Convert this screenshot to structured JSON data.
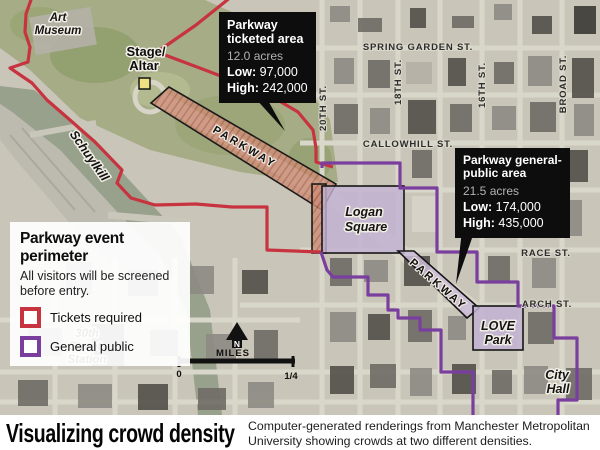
{
  "colors": {
    "tickets_red": "#c73440",
    "public_purple": "#7a3f9e",
    "ticketed_fill": "#cb8d76",
    "public_fill": "#c2b1d2",
    "callout_bg": "#0d0d0d"
  },
  "map": {
    "streets": {
      "spring_garden": "SPRING GARDEN ST.",
      "twentieth": "20TH ST.",
      "eighteenth": "18TH ST.",
      "sixteenth": "16TH ST.",
      "broad": "BROAD ST.",
      "callowhill": "CALLOWHILL ST.",
      "race": "RACE ST.",
      "arch": "ARCH ST."
    },
    "places": {
      "art_museum_1": "Art",
      "art_museum_2": "Museum",
      "stage_1": "Stage/",
      "stage_2": "Altar",
      "schuylkill": "Schuylkill",
      "logan_1": "Logan",
      "logan_2": "Square",
      "love_1": "LOVE",
      "love_2": "Park",
      "city_hall_1": "City",
      "city_hall_2": "Hall",
      "station_1": "30th",
      "station_2": "Street",
      "station_3": "Station",
      "parkway_ticketed": "PARKWAY",
      "parkway_public": "PARKWAY"
    }
  },
  "callouts": {
    "ticketed": {
      "title_1": "Parkway",
      "title_2": "ticketed area",
      "acres": "12.0 acres",
      "low_label": "Low:",
      "low_value": "97,000",
      "high_label": "High:",
      "high_value": "242,000"
    },
    "general": {
      "title_1": "Parkway general-",
      "title_2": "public area",
      "acres": "21.5 acres",
      "low_label": "Low:",
      "low_value": "174,000",
      "high_label": "High:",
      "high_value": "435,000"
    }
  },
  "legend": {
    "title": "Parkway event perimeter",
    "note_1": "All visitors will be screened",
    "note_2": "before entry.",
    "items": [
      {
        "label": "Tickets required"
      },
      {
        "label": "General public"
      }
    ]
  },
  "scale": {
    "north": "N",
    "unit": "MILES",
    "start": "0",
    "end": "1/4"
  },
  "caption": {
    "headline": "Visualizing crowd density",
    "body": "Computer-generated renderings from Manchester Metropolitan University showing crowds at two different densities."
  }
}
